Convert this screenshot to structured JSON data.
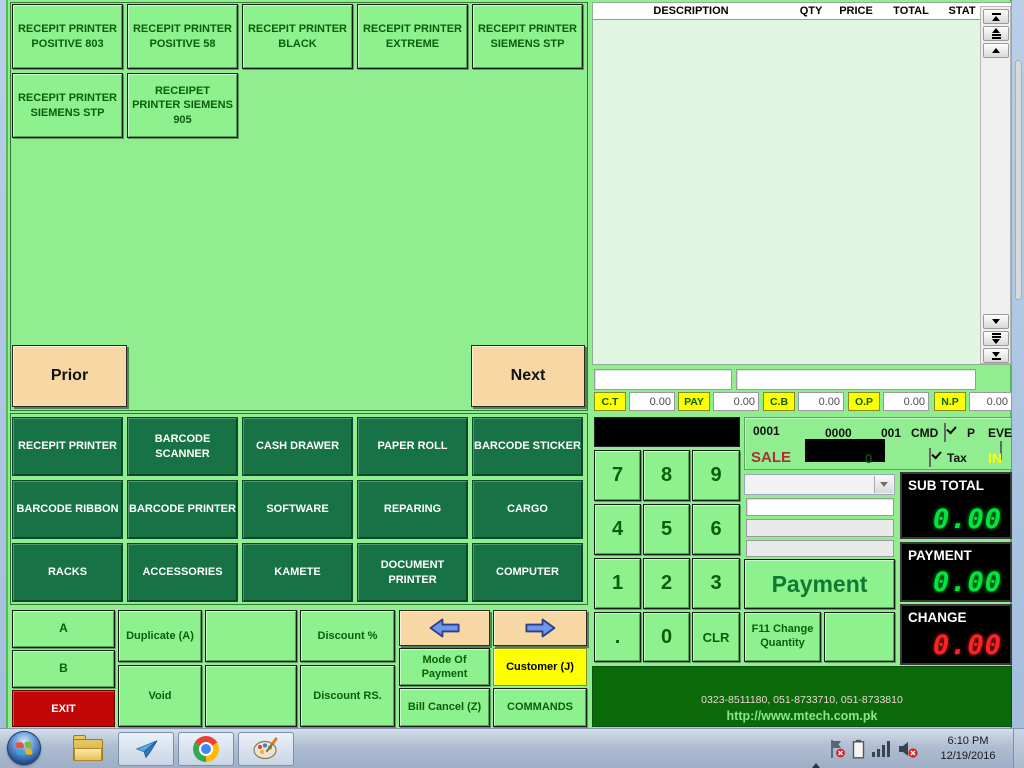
{
  "colors": {
    "light_green": "#90EE90",
    "button_green": "#8DF18D",
    "dark_green_button": "#177245",
    "footer_green": "#0A6A0A",
    "exit_red": "#C00606",
    "highlight_yellow": "#FFFF00",
    "display_green": "#00E53C",
    "display_red": "#FF2222",
    "tan": "#F7D7A3"
  },
  "product_pages": {
    "buttons": [
      "RECEPIT PRINTER POSITIVE 803",
      "RECEPIT PRINTER POSITIVE 58",
      "RECEPIT PRINTER BLACK",
      "RECEPIT PRINTER EXTREME",
      "RECEPIT PRINTER SIEMENS STP",
      "RECEPIT PRINTER SIEMENS STP",
      "RECEIPET PRINTER SIEMENS 905"
    ],
    "prior_label": "Prior",
    "next_label": "Next"
  },
  "categories": {
    "buttons": [
      "RECEPIT PRINTER",
      "BARCODE SCANNER",
      "CASH DRAWER",
      "PAPER ROLL",
      "BARCODE STICKER",
      "BARCODE RIBBON",
      "BARCODE PRINTER",
      "SOFTWARE",
      "REPARING",
      "CARGO",
      "RACKS",
      "ACCESSORIES",
      "KAMETE",
      "DOCUMENT PRINTER",
      "COMPUTER"
    ]
  },
  "controls": {
    "a_label": "A",
    "b_label": "B",
    "exit_label": "EXIT",
    "duplicate_label": "Duplicate (A)",
    "void_label": "Void",
    "discount_percent_label": "Discount %",
    "discount_rs_label": "Discount RS.",
    "mode_of_payment_label": "Mode Of Payment",
    "bill_cancel_label": "Bill Cancel (Z)",
    "customer_label": "Customer (J)",
    "commands_label": "COMMANDS"
  },
  "receipt_table": {
    "headers": [
      "DESCRIPTION",
      "QTY",
      "PRICE",
      "TOTAL",
      "STAT"
    ],
    "rows": []
  },
  "totals_row": {
    "items": [
      {
        "label": "C.T",
        "value": "0.00"
      },
      {
        "label": "PAY",
        "value": "0.00"
      },
      {
        "label": "C.B",
        "value": "0.00"
      },
      {
        "label": "O.P",
        "value": "0.00"
      },
      {
        "label": "N.P",
        "value": "0.00"
      }
    ]
  },
  "numpad": {
    "keys": [
      "7",
      "8",
      "9",
      "4",
      "5",
      "6",
      "1",
      "2",
      "3",
      ".",
      "0",
      "CLR"
    ]
  },
  "transaction": {
    "bill_no": "0001",
    "counter_no": "0000",
    "user_no": "001",
    "cmd_label": "CMD",
    "p_label": "P",
    "eve_label": "EVE",
    "mode": "SALE",
    "item_count": "0",
    "tax_label": "Tax",
    "in_label": "IN"
  },
  "payment_panel": {
    "payment_label": "Payment",
    "f11_label": "F11 Change Quantity"
  },
  "displays": {
    "subtotal": {
      "label": "SUB TOTAL",
      "value": "0.00"
    },
    "payment": {
      "label": "PAYMENT",
      "value": "0.00"
    },
    "change": {
      "label": "CHANGE",
      "value": "0.00"
    }
  },
  "footer": {
    "phones": "0323-8511180, 051-8733710, 051-8733810",
    "website": "http://www.mtech.com.pk"
  },
  "taskbar": {
    "time": "6:10 PM",
    "date": "12/19/2016"
  }
}
